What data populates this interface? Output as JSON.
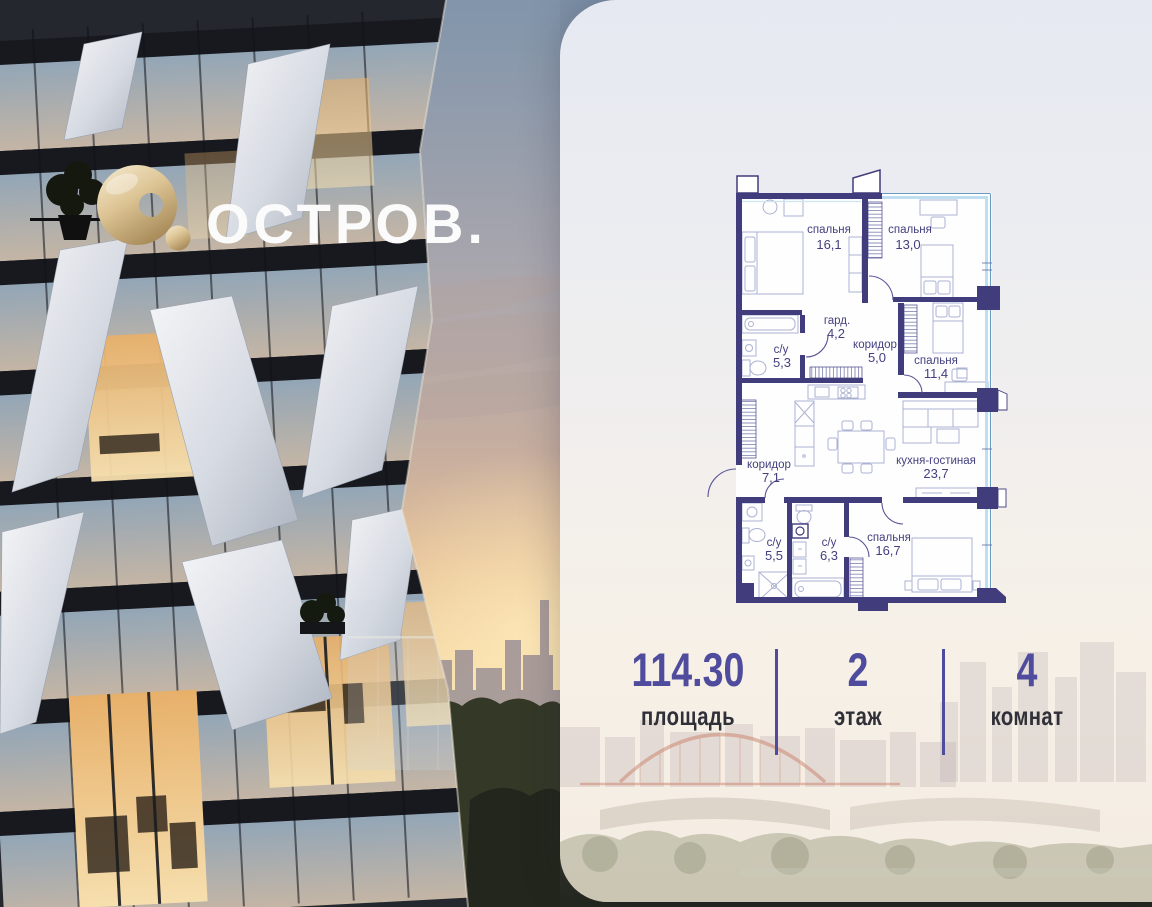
{
  "brand": {
    "name": "ОСТРОВ."
  },
  "plan": {
    "rooms": [
      {
        "name": "спальня",
        "area": "16,1"
      },
      {
        "name": "спальня",
        "area": "13,0"
      },
      {
        "name": "с/у",
        "area": "5,3"
      },
      {
        "name": "гард.",
        "area": "4,2"
      },
      {
        "name": "коридор",
        "area": "5,0"
      },
      {
        "name": "спальня",
        "area": "11,4"
      },
      {
        "name": "коридор",
        "area": "7,1"
      },
      {
        "name": "кухня-гостиная",
        "area": "23,7"
      },
      {
        "name": "с/у",
        "area": "5,5"
      },
      {
        "name": "с/у",
        "area": "6,3"
      },
      {
        "name": "спальня",
        "area": "16,7"
      }
    ]
  },
  "stats": {
    "area": {
      "value": "114.30",
      "label": "площадь"
    },
    "floor": {
      "value": "2",
      "label": "этаж"
    },
    "rooms": {
      "value": "4",
      "label": "комнат"
    }
  },
  "colors": {
    "accent": "#4f4c9e",
    "wall": "#413c7c",
    "window": "#bfdff0",
    "gold": "#d8c190",
    "label_dark": "#303038"
  }
}
